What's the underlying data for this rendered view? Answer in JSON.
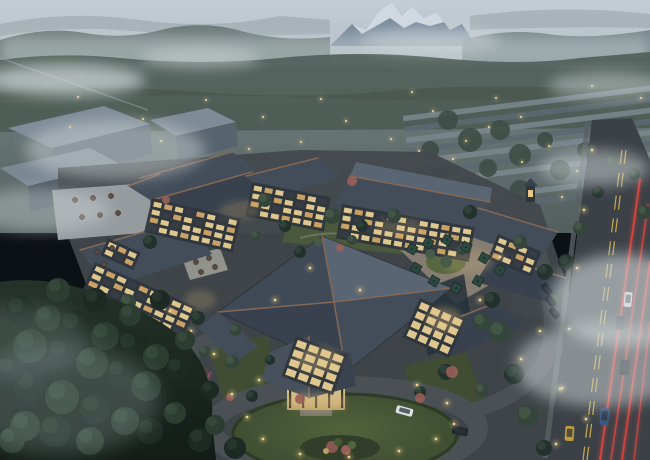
{
  "meta": {
    "type": "architectural-rendering",
    "subject": "aerial dusk view of a Chinese-style mountain resort hotel complex",
    "time_of_day": "dusk",
    "no_visible_text": true
  },
  "colors": {
    "sky_top": "#ccd5da",
    "sky_bottom": "#b9c4ca",
    "haze": "#c6d0d2",
    "snow": "#e4eaef",
    "rock": "#7e8fa0",
    "far_faint": "#98a6a8",
    "hill_left": "#677670",
    "hill_right": "#6f7e81",
    "forest_band": "#55645b",
    "valley_top": "#7d8a89",
    "valley_bottom": "#5a6662",
    "town_roof_light": "#7e8a90",
    "town_roof_dark": "#5f6c72",
    "massing": "#5a666e",
    "massing_top": "#84909a",
    "fog": "#d4dcdd",
    "fog_ground": "#93a5a5",
    "site_ground": "#45494b",
    "drive": "#4d5254",
    "road": "#3d4246",
    "sidewalk": "#5d6365",
    "roof_light": "#5d6874",
    "roof_mid": "#454f5a",
    "roof_dark": "#39424c",
    "roof_west": "#424b56",
    "ridge_copper": "#8a6b54",
    "facade_dark": "#30353b",
    "window_bright": "#f7dc9a",
    "window_mid": "#dfb06a",
    "window_dark": "#3a3f45",
    "wall_cream": "#d9c491",
    "glow_warm": "#f2cf8a",
    "light_warm": "#f5d78e",
    "lawn": "#49582f",
    "lawn_dark": "#39462a",
    "paving": "#8b8172",
    "umbrella": "#2c4a40",
    "table": "#5d4a3f",
    "tree_dark": "#22312a",
    "tree_mid": "#35473a",
    "tree_light": "#4a5c48",
    "fg1": "#1d2a23",
    "fg2": "#2b3c31",
    "fg3": "#3a4e3f",
    "line_yellow": "#c9a94d",
    "tail_red": "#e8463e",
    "brake_pink": "#d85a62",
    "car_white": "#e8eaea",
    "car_dark": "#23282c",
    "car_blue": "#3c5a85",
    "car_yellow": "#c9a23c",
    "accent_bush": "#a06258",
    "deck": "#9ba1a2"
  },
  "scene": {
    "town_lights": [
      [
        78,
        97
      ],
      [
        206,
        100
      ],
      [
        321,
        99
      ],
      [
        412,
        92
      ],
      [
        496,
        98
      ],
      [
        592,
        86
      ],
      [
        641,
        98
      ],
      [
        70,
        127
      ],
      [
        143,
        119
      ],
      [
        263,
        117
      ],
      [
        346,
        121
      ],
      [
        433,
        111
      ],
      [
        521,
        117
      ],
      [
        613,
        124
      ],
      [
        161,
        141
      ],
      [
        249,
        149
      ],
      [
        301,
        142
      ],
      [
        391,
        139
      ],
      [
        466,
        141
      ],
      [
        549,
        146
      ],
      [
        631,
        151
      ],
      [
        522,
        162
      ],
      [
        577,
        171
      ],
      [
        612,
        184
      ],
      [
        639,
        199
      ],
      [
        562,
        197
      ],
      [
        530,
        182
      ],
      [
        489,
        127
      ],
      [
        453,
        159
      ],
      [
        419,
        151
      ],
      [
        585,
        212
      ],
      [
        625,
        226
      ],
      [
        603,
        243
      ],
      [
        638,
        262
      ]
    ],
    "ground_lights": [
      [
        232,
        394
      ],
      [
        247,
        417
      ],
      [
        263,
        439
      ],
      [
        300,
        454
      ],
      [
        349,
        457
      ],
      [
        399,
        451
      ],
      [
        436,
        439
      ],
      [
        454,
        424
      ],
      [
        447,
        403
      ],
      [
        417,
        385
      ],
      [
        259,
        380
      ],
      [
        214,
        354
      ],
      [
        191,
        331
      ],
      [
        170,
        311
      ],
      [
        480,
        300
      ],
      [
        500,
        257
      ],
      [
        540,
        331
      ],
      [
        521,
        359
      ],
      [
        560,
        389
      ],
      [
        586,
        419
      ],
      [
        592,
        150
      ],
      [
        584,
        210
      ],
      [
        577,
        268
      ],
      [
        569,
        329
      ],
      [
        562,
        388
      ],
      [
        556,
        444
      ],
      [
        360,
        290
      ],
      [
        310,
        268
      ],
      [
        275,
        300
      ]
    ],
    "glow_spots": [
      [
        318,
        360,
        24,
        13,
        0.3
      ],
      [
        444,
        320,
        18,
        13,
        0.3
      ],
      [
        316,
        402,
        30,
        9,
        0.35
      ],
      [
        468,
        262,
        26,
        12,
        0.2
      ],
      [
        200,
        300,
        16,
        10,
        0.2
      ],
      [
        240,
        210,
        20,
        10,
        0.15
      ],
      [
        400,
        228,
        26,
        10,
        0.18
      ]
    ],
    "fog_patches": [
      [
        65,
        80,
        80,
        16,
        0.7
      ],
      [
        200,
        58,
        60,
        10,
        0.5
      ],
      [
        430,
        40,
        70,
        12,
        0.55
      ],
      [
        595,
        168,
        55,
        18,
        0.5
      ],
      [
        622,
        300,
        72,
        46,
        0.6
      ],
      [
        600,
        365,
        85,
        42,
        0.5
      ],
      [
        115,
        150,
        90,
        30,
        0.45
      ],
      [
        40,
        210,
        70,
        22,
        0.4
      ],
      [
        608,
        86,
        60,
        14,
        0.45
      ]
    ],
    "facades": [
      {
        "name": "west-wing",
        "x": 95,
        "y": 262,
        "rot": 24,
        "cols": 9,
        "rows": 5,
        "cw": 9,
        "ch": 5
      },
      {
        "name": "west-upper",
        "x": 108,
        "y": 238,
        "rot": 24,
        "cols": 3,
        "rows": 2,
        "cw": 8,
        "ch": 5
      },
      {
        "name": "nw-block",
        "x": 152,
        "y": 198,
        "rot": 13,
        "cols": 8,
        "rows": 4,
        "cw": 8,
        "ch": 5
      },
      {
        "name": "north-block",
        "x": 252,
        "y": 182,
        "rot": 11,
        "cols": 7,
        "rows": 4,
        "cw": 8,
        "ch": 5
      },
      {
        "name": "ne-block",
        "x": 342,
        "y": 204,
        "rot": 10,
        "cols": 12,
        "rows": 4,
        "cw": 8,
        "ch": 5
      },
      {
        "name": "east-block",
        "x": 498,
        "y": 234,
        "rot": 22,
        "cols": 4,
        "rows": 3,
        "cw": 8,
        "ch": 5
      },
      {
        "name": "atrium-left",
        "x": 296,
        "y": 336,
        "rot": 20,
        "cols": 4,
        "rows": 4,
        "cw": 10,
        "ch": 7,
        "bright": true
      },
      {
        "name": "atrium-right",
        "x": 420,
        "y": 298,
        "rot": 24,
        "cols": 4,
        "rows": 4,
        "cw": 9,
        "ch": 7,
        "bright": true
      }
    ],
    "umbrellas": [
      [
        412,
        249
      ],
      [
        428,
        243
      ],
      [
        447,
        240
      ],
      [
        466,
        247
      ],
      [
        484,
        258
      ],
      [
        500,
        270
      ],
      [
        478,
        281
      ],
      [
        456,
        288
      ],
      [
        434,
        281
      ],
      [
        416,
        268
      ]
    ],
    "tables": [
      [
        75,
        200
      ],
      [
        93,
        198
      ],
      [
        111,
        196
      ],
      [
        82,
        217
      ],
      [
        100,
        215
      ],
      [
        118,
        213
      ],
      [
        97,
        252
      ],
      [
        112,
        248
      ],
      [
        104,
        264
      ],
      [
        196,
        262
      ],
      [
        209,
        258
      ],
      [
        201,
        272
      ],
      [
        215,
        267
      ]
    ],
    "site_trees": [
      [
        265,
        200,
        7,
        1
      ],
      [
        285,
        226,
        6,
        0
      ],
      [
        332,
        216,
        8,
        1
      ],
      [
        362,
        226,
        6,
        0
      ],
      [
        394,
        216,
        7,
        1
      ],
      [
        300,
        252,
        6,
        0
      ],
      [
        256,
        236,
        5,
        1
      ],
      [
        150,
        242,
        7,
        0
      ],
      [
        128,
        302,
        8,
        1
      ],
      [
        198,
        318,
        7,
        0
      ],
      [
        236,
        330,
        6,
        1
      ],
      [
        470,
        212,
        7,
        0
      ],
      [
        520,
        242,
        7,
        1
      ],
      [
        545,
        272,
        8,
        0
      ],
      [
        482,
        322,
        9,
        1
      ],
      [
        446,
        372,
        8,
        0
      ],
      [
        482,
        390,
        7,
        1
      ],
      [
        420,
        392,
        6,
        0
      ],
      [
        232,
        362,
        7,
        1
      ],
      [
        252,
        396,
        6,
        0
      ],
      [
        500,
        332,
        11,
        1
      ],
      [
        514,
        374,
        10,
        0
      ],
      [
        528,
        416,
        11,
        1
      ],
      [
        544,
        448,
        8,
        0
      ],
      [
        492,
        300,
        8,
        0
      ],
      [
        556,
        300,
        7,
        1
      ],
      [
        566,
        262,
        8,
        0
      ],
      [
        580,
        228,
        7,
        1
      ],
      [
        598,
        192,
        6,
        0
      ],
      [
        612,
        162,
        6,
        1
      ],
      [
        634,
        174,
        6,
        0
      ],
      [
        644,
        212,
        7,
        1
      ],
      [
        446,
        262,
        6,
        2
      ],
      [
        462,
        250,
        5,
        1
      ],
      [
        430,
        254,
        5,
        2
      ],
      [
        352,
        240,
        5,
        1
      ],
      [
        318,
        242,
        4,
        2
      ],
      [
        205,
        352,
        6,
        1
      ],
      [
        270,
        360,
        5,
        0
      ]
    ],
    "town_trees": [
      [
        448,
        120,
        10
      ],
      [
        470,
        140,
        12
      ],
      [
        430,
        150,
        9
      ],
      [
        500,
        130,
        10
      ],
      [
        520,
        155,
        11
      ],
      [
        488,
        168,
        9
      ],
      [
        545,
        140,
        8
      ],
      [
        560,
        170,
        10
      ],
      [
        585,
        150,
        8
      ],
      [
        610,
        140,
        9
      ],
      [
        600,
        175,
        8
      ],
      [
        630,
        190,
        9
      ],
      [
        520,
        190,
        10
      ],
      [
        470,
        185,
        9
      ],
      [
        440,
        175,
        8
      ]
    ],
    "fg_trees": [
      [
        20,
        310,
        15,
        0
      ],
      [
        48,
        318,
        13,
        1
      ],
      [
        75,
        326,
        16,
        0
      ],
      [
        105,
        336,
        14,
        1
      ],
      [
        132,
        346,
        15,
        0
      ],
      [
        156,
        357,
        13,
        1
      ],
      [
        178,
        369,
        12,
        0
      ],
      [
        30,
        346,
        17,
        1
      ],
      [
        62,
        353,
        15,
        0
      ],
      [
        92,
        363,
        16,
        1
      ],
      [
        120,
        373,
        14,
        0
      ],
      [
        146,
        386,
        15,
        1
      ],
      [
        30,
        386,
        16,
        0
      ],
      [
        62,
        397,
        17,
        1
      ],
      [
        95,
        409,
        15,
        0
      ],
      [
        125,
        421,
        14,
        1
      ],
      [
        55,
        431,
        16,
        0
      ],
      [
        90,
        441,
        14,
        1
      ],
      [
        25,
        426,
        15,
        1
      ],
      [
        150,
        431,
        13,
        0
      ],
      [
        175,
        413,
        11,
        1
      ],
      [
        200,
        440,
        12,
        0
      ],
      [
        215,
        425,
        10,
        1
      ],
      [
        235,
        448,
        11,
        0
      ],
      [
        58,
        290,
        12,
        1
      ],
      [
        95,
        300,
        12,
        0
      ],
      [
        130,
        315,
        11,
        1
      ],
      [
        10,
        370,
        14,
        0
      ],
      [
        12,
        440,
        13,
        1
      ],
      [
        160,
        300,
        10,
        0
      ],
      [
        185,
        340,
        10,
        1
      ],
      [
        210,
        390,
        9,
        0
      ]
    ],
    "accent_bushes": [
      [
        352,
        181,
        5
      ],
      [
        340,
        248,
        4
      ],
      [
        452,
        372,
        6
      ],
      [
        300,
        399,
        5
      ],
      [
        230,
        397,
        4
      ],
      [
        166,
        200,
        4
      ],
      [
        420,
        398,
        5
      ]
    ],
    "cars": [
      {
        "x": 396,
        "y": 407,
        "w": 17,
        "h": 8,
        "c": "car_white",
        "rot": 15
      },
      {
        "x": 452,
        "y": 427,
        "w": 16,
        "h": 8,
        "c": "car_dark",
        "rot": 10
      },
      {
        "x": 170,
        "y": 366,
        "w": 8,
        "h": 14,
        "c": "car_dark",
        "rot": 18
      },
      {
        "x": 624,
        "y": 292,
        "w": 8,
        "h": 15,
        "c": "car_white",
        "rot": 6
      },
      {
        "x": 616,
        "y": 316,
        "w": 8,
        "h": 14,
        "c": "car_dark",
        "rot": 6
      },
      {
        "x": 620,
        "y": 360,
        "w": 9,
        "h": 15,
        "c": "car_dark",
        "rot": 6
      },
      {
        "x": 600,
        "y": 408,
        "w": 9,
        "h": 17,
        "c": "car_blue",
        "rot": 6
      },
      {
        "x": 565,
        "y": 426,
        "w": 9,
        "h": 15,
        "c": "car_yellow",
        "rot": 4
      },
      {
        "x": 543,
        "y": 283,
        "w": 7,
        "h": 12,
        "c": "car_dark",
        "rot": -38
      },
      {
        "x": 547,
        "y": 295,
        "w": 7,
        "h": 12,
        "c": "car_dark",
        "rot": -38
      },
      {
        "x": 551,
        "y": 307,
        "w": 7,
        "h": 12,
        "c": "car_dark",
        "rot": -38
      }
    ],
    "red_streaks": [
      [
        640,
        180,
        600,
        460,
        2,
        0.9,
        "tail_red"
      ],
      [
        648,
        205,
        611,
        460,
        1.6,
        0.8,
        "tail_red"
      ],
      [
        650,
        262,
        622,
        460,
        2,
        0.85,
        "tail_red"
      ],
      [
        650,
        322,
        634,
        460,
        1.6,
        0.7,
        "tail_red"
      ],
      [
        160,
        455,
        203,
        370,
        1.8,
        0.8,
        "brake_pink"
      ],
      [
        168,
        458,
        210,
        373,
        1.4,
        0.7,
        "brake_pink"
      ]
    ]
  }
}
